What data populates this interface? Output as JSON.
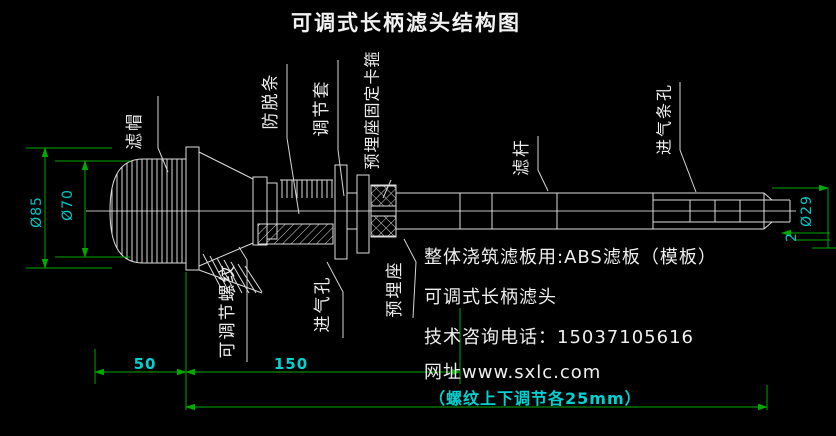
{
  "title": "可调式长柄滤头结构图",
  "part_labels": {
    "filter_cap": "滤帽",
    "anti_release_strip": "防脱条",
    "adjusting_sleeve": "调节套",
    "embedded_seat_fixing_clamp": "预埋座固定卡箍",
    "filter_rod": "滤杆",
    "air_inlet_slot_holes": "进气条孔",
    "adjustable_thread": "可调节螺纹",
    "air_inlet_hole": "进气孔",
    "embedded_seat": "预埋座"
  },
  "dimensions": {
    "cap_outer_diameter": "Ø85",
    "cap_body_diameter": "Ø70",
    "rod_end_diameter": "Ø29",
    "wall_thickness": "2",
    "head_section_length": "50",
    "adjust_section_length": "150",
    "thread_adjustment_note": "（螺纹上下调节各25mm）"
  },
  "notes": {
    "filter_plate": "整体浇筑滤板用:ABS滤板（模板）",
    "product_name": "可调式长柄滤头",
    "phone": "技术咨询电话：15037105616",
    "website": "网址www.sxlc.com"
  },
  "colors": {
    "background": "#000000",
    "drawing_line": "#e0e0e0",
    "dimension_line": "#00a800",
    "dimension_text": "#00c8c8",
    "label_text": "#ededed"
  }
}
